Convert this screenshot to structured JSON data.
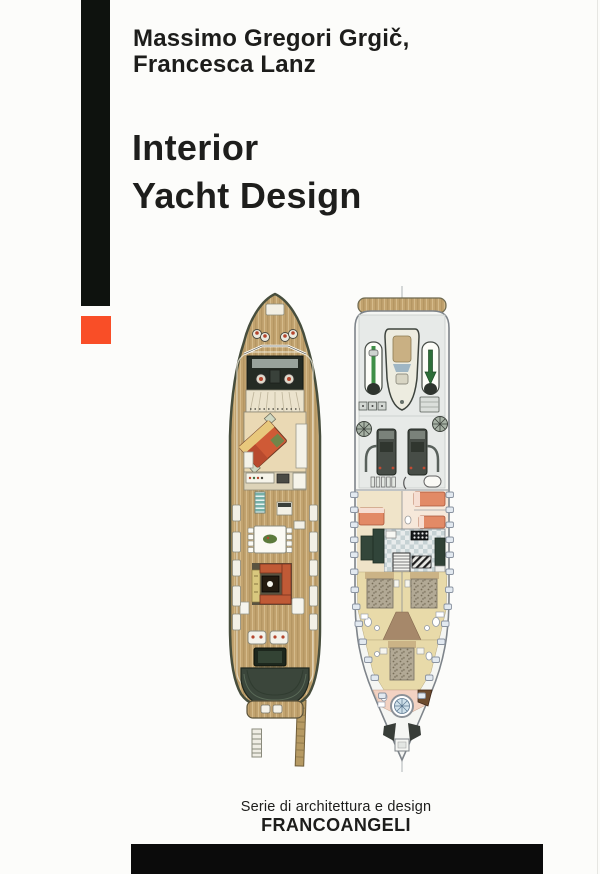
{
  "cover": {
    "authors": [
      "Massimo Gregori Grgič,",
      "Francesca Lanz"
    ],
    "title_lines": [
      "Interior",
      "Yacht Design"
    ],
    "series_label": "Serie di architettura e design",
    "publisher": "FRANCOANGELI",
    "colors": {
      "accent_orange": "#f94e27",
      "spine_black": "#0e120e",
      "footer_black": "#0b0b0b",
      "text": "#1d1d1b",
      "teak_deck": "#c2a36f",
      "hull_outline_dark": "#474e3d",
      "stern_green": "#3b463b",
      "salon_beige": "#ead9b4",
      "sofa_orange": "#c05a36",
      "bed_salmon": "#e28a66",
      "galley_tile_gray": "#c6d2d4",
      "counter_green": "#31453a",
      "lower_hull_white": "#f5f6f3",
      "porthole_blue": "#e2e9f0"
    }
  }
}
